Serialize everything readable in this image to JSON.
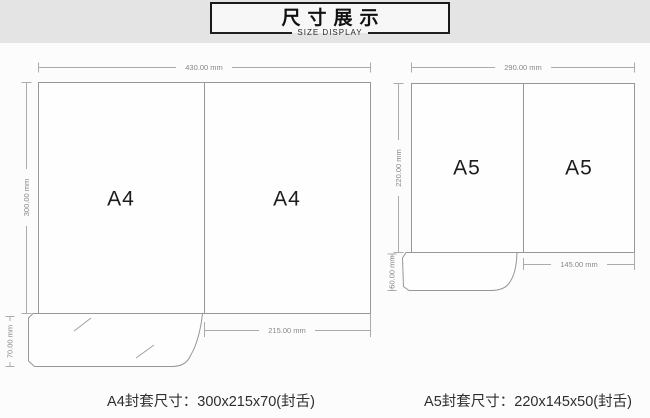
{
  "banner": {
    "title": "尺寸展示",
    "subtitle": "SIZE DISPLAY"
  },
  "a4": {
    "panel_left": "A4",
    "panel_right": "A4",
    "width_label": "430.00 mm",
    "height_label": "300.00 mm",
    "flap_label": "70.00 mm",
    "panel_width_label": "215.00 mm",
    "caption": "A4封套尺寸：300x215x70(封舌)"
  },
  "a5": {
    "panel_left": "A5",
    "panel_right": "A5",
    "width_label": "290.00 mm",
    "height_label": "220.00 mm",
    "flap_label": "50.00 mm",
    "panel_width_label": "145.00 mm",
    "caption": "A5封套尺寸：220x145x50(封舌)"
  },
  "colors": {
    "strip_bg": "#e4e4e4",
    "page_bg": "#fcfcfc",
    "banner_border": "#1a1a1a",
    "diagram_line": "#979797",
    "dimension_line": "#ababab",
    "dimension_text": "#878787",
    "label_text": "#1c1c1c"
  }
}
